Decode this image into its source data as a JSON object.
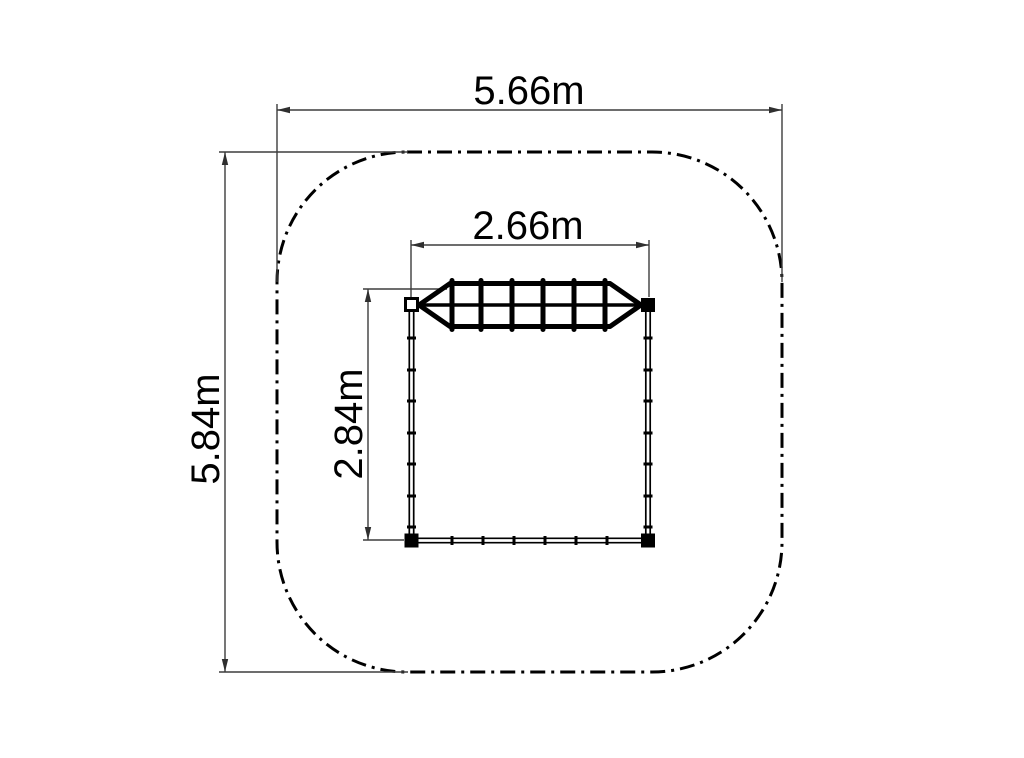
{
  "diagram": {
    "type": "plan-view technical drawing",
    "subject": "climbing frame with net bridge, top view, inside rounded safety-zone boundary",
    "dimensions": {
      "overall_width_label": "5.66m",
      "overall_height_label": "5.84m",
      "structure_width_label": "2.66m",
      "structure_height_label": "2.84m"
    },
    "boundary": {
      "style": "dash-dot rounded square",
      "meaning": "safety zone outline"
    },
    "colors": {
      "background": "#ffffff",
      "structure_line": "#000000",
      "dimension_line": "#3d3d3d",
      "text": "#000000"
    }
  }
}
